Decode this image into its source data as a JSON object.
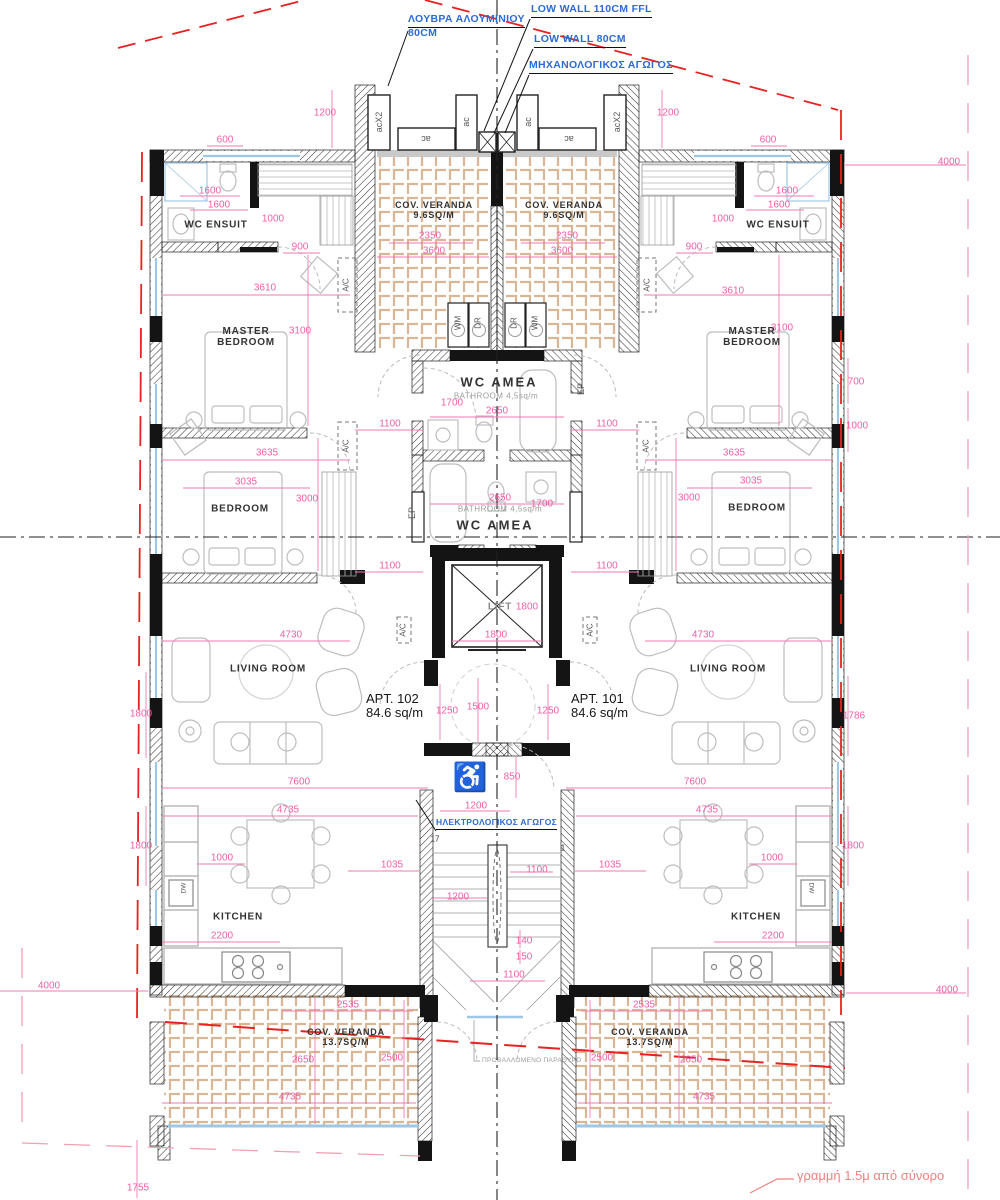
{
  "colors": {
    "dimension_pink": "#ee5fa7",
    "boundary_red": "#e62222",
    "offset_pink": "#f2a0b4",
    "callout_blue": "#2b6bd4",
    "wall_black": "#141414",
    "tile_tan": "#d2ab84",
    "window_blue": "#9ec7e6",
    "furniture_gray": "#bdbdbd",
    "centerline": "#222222"
  },
  "callouts": [
    {
      "lines": [
        "ΛΟΥΒΡΑ ΑΛΟΥΜΙΝΙΟΥ",
        "80CM"
      ],
      "x": 408,
      "y": 14
    },
    {
      "lines": [
        "LOW WALL 110CM FFL"
      ],
      "x": 531,
      "y": 4
    },
    {
      "lines": [
        "LOW WALL 80CM"
      ],
      "x": 534,
      "y": 34
    },
    {
      "lines": [
        "ΜΗΧΑΝΟΛΟΓΙΚΟΣ ΑΓΩΓΟΣ"
      ],
      "x": 529,
      "y": 60
    },
    {
      "lines": [
        "ΗΛΕΚΤΡΟΛΟΓΙΚΟΣ ΑΓΩΓΟΣ"
      ],
      "x": 436,
      "y": 818,
      "size": 8.5
    }
  ],
  "rooms": [
    {
      "lines": [
        "WC ENSUIT"
      ],
      "x": 216,
      "y": 225
    },
    {
      "lines": [
        "WC ENSUIT"
      ],
      "x": 778,
      "y": 225
    },
    {
      "lines": [
        "MASTER",
        "BEDROOM"
      ],
      "x": 246,
      "y": 337
    },
    {
      "lines": [
        "MASTER",
        "BEDROOM"
      ],
      "x": 752,
      "y": 337
    },
    {
      "lines": [
        "BEDROOM"
      ],
      "x": 240,
      "y": 509
    },
    {
      "lines": [
        "BEDROOM"
      ],
      "x": 757,
      "y": 508
    },
    {
      "lines": [
        "LIVING ROOM"
      ],
      "x": 268,
      "y": 669
    },
    {
      "lines": [
        "LIVING ROOM"
      ],
      "x": 728,
      "y": 669
    },
    {
      "lines": [
        "KITCHEN"
      ],
      "x": 238,
      "y": 917
    },
    {
      "lines": [
        "KITCHEN"
      ],
      "x": 756,
      "y": 917
    },
    {
      "lines": [
        "COV. VERANDA",
        "9.6SQ/M"
      ],
      "x": 434,
      "y": 210,
      "size": 9
    },
    {
      "lines": [
        "COV. VERANDA",
        "9.6SQ/M"
      ],
      "x": 564,
      "y": 210,
      "size": 9
    },
    {
      "lines": [
        "COV. VERANDA",
        "13.7SQ/M"
      ],
      "x": 346,
      "y": 1037,
      "size": 9
    },
    {
      "lines": [
        "COV. VERANDA",
        "13.7SQ/M"
      ],
      "x": 650,
      "y": 1037,
      "size": 9
    },
    {
      "lines": [
        "WC AMEA"
      ],
      "x": 499,
      "y": 383,
      "size": 13,
      "ls": 2
    },
    {
      "lines": [
        "WC AMEA"
      ],
      "x": 495,
      "y": 526,
      "size": 13,
      "ls": 2
    },
    {
      "lines": [
        "LIFT"
      ],
      "x": 500,
      "y": 607,
      "color": "#8a8a8a",
      "size": 10
    }
  ],
  "subs": [
    {
      "t": "BATHROOM  4,5sq/m",
      "x": 496,
      "y": 397
    },
    {
      "t": "BATHROOM  4,5sq/m",
      "x": 500,
      "y": 510
    }
  ],
  "apartments": [
    {
      "name": "APT. 102",
      "area": "84.6 sq/m",
      "x": 366,
      "y": 692
    },
    {
      "name": "APT. 101",
      "area": "84.6 sq/m",
      "x": 571,
      "y": 692
    }
  ],
  "dimensions": [
    {
      "t": "600",
      "x": 225,
      "y": 140
    },
    {
      "t": "600",
      "x": 768,
      "y": 140
    },
    {
      "t": "1200",
      "x": 325,
      "y": 113
    },
    {
      "t": "1200",
      "x": 668,
      "y": 113
    },
    {
      "t": "4000",
      "x": 949,
      "y": 162
    },
    {
      "t": "4000",
      "x": 49,
      "y": 986
    },
    {
      "t": "4000",
      "x": 947,
      "y": 990
    },
    {
      "t": "1600",
      "x": 210,
      "y": 191
    },
    {
      "t": "1600",
      "x": 219,
      "y": 205
    },
    {
      "t": "1600",
      "x": 787,
      "y": 191
    },
    {
      "t": "1600",
      "x": 779,
      "y": 205
    },
    {
      "t": "1000",
      "x": 273,
      "y": 219
    },
    {
      "t": "1000",
      "x": 723,
      "y": 219
    },
    {
      "t": "900",
      "x": 300,
      "y": 247
    },
    {
      "t": "900",
      "x": 694,
      "y": 247
    },
    {
      "t": "2350",
      "x": 430,
      "y": 236
    },
    {
      "t": "2350",
      "x": 567,
      "y": 236
    },
    {
      "t": "3600",
      "x": 434,
      "y": 251
    },
    {
      "t": "3600",
      "x": 562,
      "y": 251
    },
    {
      "t": "3610",
      "x": 265,
      "y": 288
    },
    {
      "t": "3610",
      "x": 733,
      "y": 291
    },
    {
      "t": "3100",
      "x": 300,
      "y": 331
    },
    {
      "t": "3100",
      "x": 782,
      "y": 328
    },
    {
      "t": "700",
      "x": 856,
      "y": 382
    },
    {
      "t": "1000",
      "x": 857,
      "y": 426
    },
    {
      "t": "1100",
      "x": 390,
      "y": 424
    },
    {
      "t": "1100",
      "x": 607,
      "y": 424
    },
    {
      "t": "1100",
      "x": 390,
      "y": 566
    },
    {
      "t": "1100",
      "x": 607,
      "y": 566
    },
    {
      "t": "1700",
      "x": 452,
      "y": 403
    },
    {
      "t": "2650",
      "x": 497,
      "y": 411
    },
    {
      "t": "2650",
      "x": 500,
      "y": 498
    },
    {
      "t": "1700",
      "x": 542,
      "y": 504
    },
    {
      "t": "3635",
      "x": 267,
      "y": 453
    },
    {
      "t": "3635",
      "x": 734,
      "y": 453
    },
    {
      "t": "3035",
      "x": 246,
      "y": 482
    },
    {
      "t": "3035",
      "x": 751,
      "y": 481
    },
    {
      "t": "3000",
      "x": 307,
      "y": 499
    },
    {
      "t": "3000",
      "x": 689,
      "y": 498
    },
    {
      "t": "1800",
      "x": 527,
      "y": 607
    },
    {
      "t": "1800",
      "x": 496,
      "y": 635
    },
    {
      "t": "4730",
      "x": 291,
      "y": 635
    },
    {
      "t": "4730",
      "x": 703,
      "y": 635
    },
    {
      "t": "1250",
      "x": 447,
      "y": 711
    },
    {
      "t": "1500",
      "x": 478,
      "y": 707
    },
    {
      "t": "1250",
      "x": 548,
      "y": 711
    },
    {
      "t": "850",
      "x": 512,
      "y": 777
    },
    {
      "t": "1786",
      "x": 854,
      "y": 716
    },
    {
      "t": "1800",
      "x": 141,
      "y": 714
    },
    {
      "t": "7600",
      "x": 299,
      "y": 782
    },
    {
      "t": "7600",
      "x": 695,
      "y": 782
    },
    {
      "t": "1200",
      "x": 476,
      "y": 806
    },
    {
      "t": "1035",
      "x": 392,
      "y": 865
    },
    {
      "t": "1035",
      "x": 610,
      "y": 865
    },
    {
      "t": "1100",
      "x": 537,
      "y": 870
    },
    {
      "t": "1200",
      "x": 458,
      "y": 897
    },
    {
      "t": "1000",
      "x": 222,
      "y": 858
    },
    {
      "t": "1000",
      "x": 772,
      "y": 858
    },
    {
      "t": "1800",
      "x": 141,
      "y": 846
    },
    {
      "t": "1800",
      "x": 853,
      "y": 846
    },
    {
      "t": "2200",
      "x": 222,
      "y": 936
    },
    {
      "t": "2200",
      "x": 773,
      "y": 936
    },
    {
      "t": "140",
      "x": 524,
      "y": 941
    },
    {
      "t": "150",
      "x": 524,
      "y": 957
    },
    {
      "t": "1100",
      "x": 514,
      "y": 975
    },
    {
      "t": "4735",
      "x": 288,
      "y": 810
    },
    {
      "t": "4735",
      "x": 707,
      "y": 810
    },
    {
      "t": "4735",
      "x": 290,
      "y": 1097
    },
    {
      "t": "4735",
      "x": 704,
      "y": 1097
    },
    {
      "t": "2535",
      "x": 348,
      "y": 1005
    },
    {
      "t": "2535",
      "x": 644,
      "y": 1005
    },
    {
      "t": "2650",
      "x": 303,
      "y": 1060
    },
    {
      "t": "2650",
      "x": 691,
      "y": 1060
    },
    {
      "t": "2500",
      "x": 392,
      "y": 1058
    },
    {
      "t": "2500",
      "x": 602,
      "y": 1058
    },
    {
      "t": "1755",
      "x": 138,
      "y": 1188
    }
  ],
  "tags": [
    {
      "t": "A/C",
      "x": 347,
      "y": 285,
      "r": -90
    },
    {
      "t": "A/C",
      "x": 648,
      "y": 285,
      "r": -90
    },
    {
      "t": "A/C",
      "x": 347,
      "y": 446,
      "r": -90
    },
    {
      "t": "A/C",
      "x": 647,
      "y": 446,
      "r": -90
    },
    {
      "t": "A/C",
      "x": 404,
      "y": 630,
      "r": -90
    },
    {
      "t": "A/C",
      "x": 591,
      "y": 630,
      "r": -90
    },
    {
      "t": "EP",
      "x": 581,
      "y": 389,
      "r": -90,
      "size": 9
    },
    {
      "t": "EP",
      "x": 412,
      "y": 513,
      "r": -90,
      "size": 9
    },
    {
      "t": "WM",
      "x": 459,
      "y": 323,
      "r": -90
    },
    {
      "t": "DR",
      "x": 479,
      "y": 323,
      "r": -90
    },
    {
      "t": "DR",
      "x": 515,
      "y": 323,
      "r": -90
    },
    {
      "t": "WM",
      "x": 536,
      "y": 323,
      "r": -90
    },
    {
      "t": "acX2",
      "x": 379,
      "y": 122,
      "r": -90,
      "size": 9
    },
    {
      "t": "ac",
      "x": 466,
      "y": 122,
      "r": -90,
      "size": 9
    },
    {
      "t": "ac",
      "x": 528,
      "y": 122,
      "r": -90,
      "size": 9
    },
    {
      "t": "acX2",
      "x": 617,
      "y": 122,
      "r": -90,
      "size": 9
    },
    {
      "t": "ac",
      "x": 426,
      "y": 139,
      "r": 180,
      "size": 9
    },
    {
      "t": "ac",
      "x": 569,
      "y": 139,
      "r": 180,
      "size": 9
    },
    {
      "t": "DW",
      "x": 184,
      "y": 888,
      "r": -90,
      "size": 6.5
    },
    {
      "t": "DW",
      "x": 811,
      "y": 888,
      "r": 90,
      "size": 6.5
    },
    {
      "t": "17",
      "x": 435,
      "y": 840,
      "color": "#333"
    },
    {
      "t": "1",
      "x": 563,
      "y": 849,
      "color": "#333"
    },
    {
      "t": "♿",
      "x": 470,
      "y": 777,
      "size": 28,
      "color": "#b9b9b9"
    }
  ],
  "notes": {
    "boundary": "γραμμή 1.5μ από σύνορο",
    "window": "ΠΡΟΒΑΛΛΟΜΕΝΟ ΠΑΡΑΘΥΡΟ"
  }
}
